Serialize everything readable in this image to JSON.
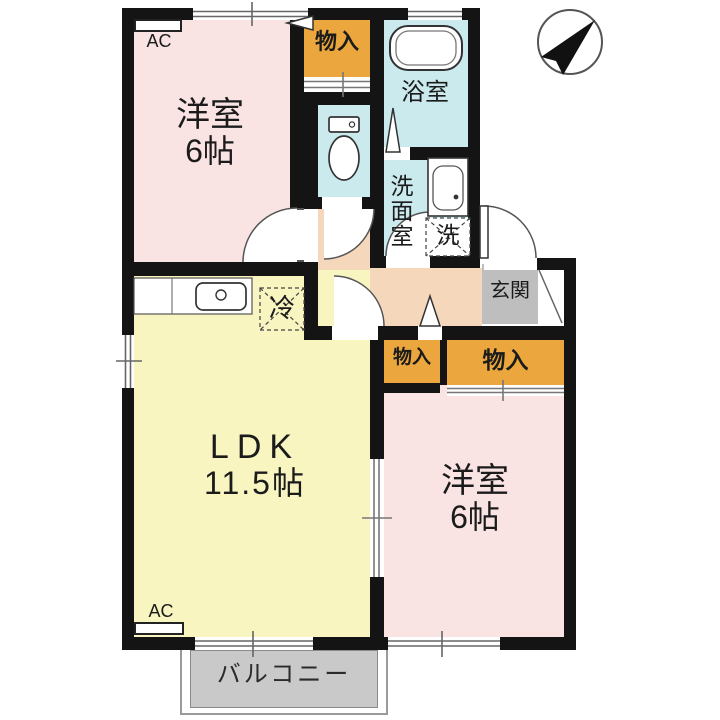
{
  "plan": {
    "rooms": {
      "bedroom_top_left": {
        "name": "洋室",
        "size": "6帖"
      },
      "bedroom_bottom_right": {
        "name": "洋室",
        "size": "6帖"
      },
      "ldk": {
        "name": "LDK",
        "size": "11.5帖"
      },
      "bathroom": {
        "name": "浴室"
      },
      "washroom": {
        "name": "洗面室"
      },
      "entrance": {
        "name": "玄関"
      },
      "balcony": {
        "name": "バルコニー"
      },
      "storage_top": {
        "name": "物入"
      },
      "storage_left": {
        "name": "物入"
      },
      "storage_right": {
        "name": "物入"
      }
    },
    "fixtures": {
      "ac_top": "AC",
      "ac_bottom": "AC",
      "refrigerator": "冷",
      "washing_machine": "洗"
    },
    "icons": {
      "compass": "north-arrow-icon",
      "toilet": "toilet-icon",
      "bathtub": "bathtub-icon",
      "kitchen_sink": "kitchen-sink-icon",
      "wash_basin": "wash-basin-icon"
    },
    "colors": {
      "wall": "#141414",
      "bedroom": "#F9E4E3",
      "ldk": "#F8F5C1",
      "wet_area": "#CBEAEE",
      "storage": "#EBA73D",
      "hallway": "#F5D8BB",
      "entrance_mat": "#BEBEBE",
      "balcony": "#C9C9C9"
    }
  }
}
